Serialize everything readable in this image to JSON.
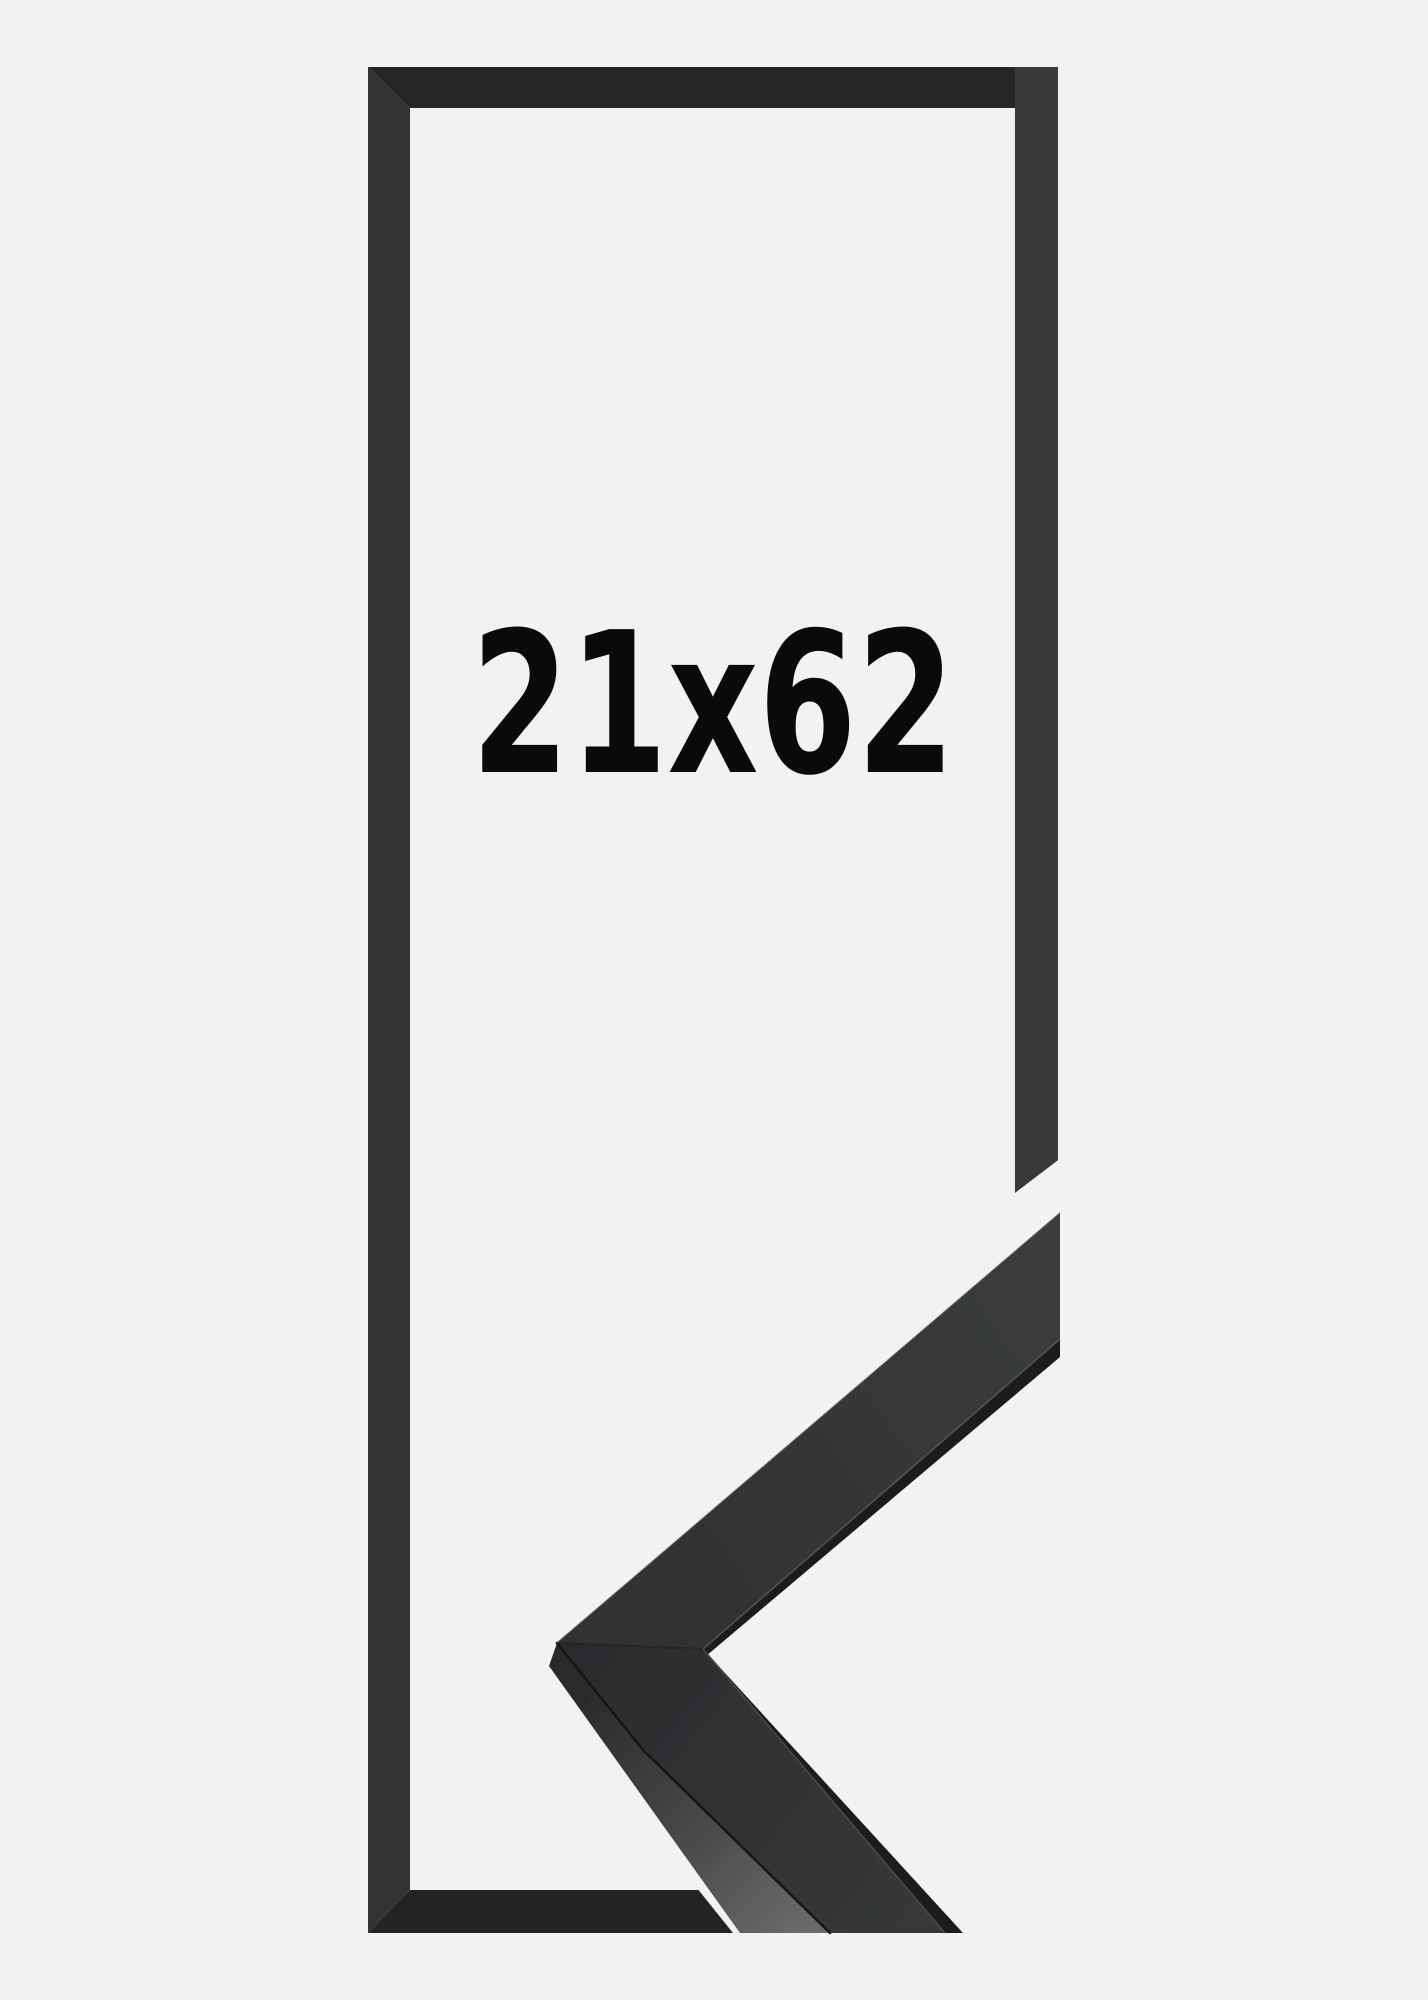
{
  "product": {
    "size_label": "21x62"
  },
  "image": {
    "description_parts": {
      "flat_frame_graphic": "black picture frame outline",
      "corner_sample": "black moulding corner profile sample"
    }
  },
  "colors": {
    "background": "#f2f2f2",
    "frame-dark": "#2b2b2c",
    "label-text": "#0a0a0a"
  }
}
